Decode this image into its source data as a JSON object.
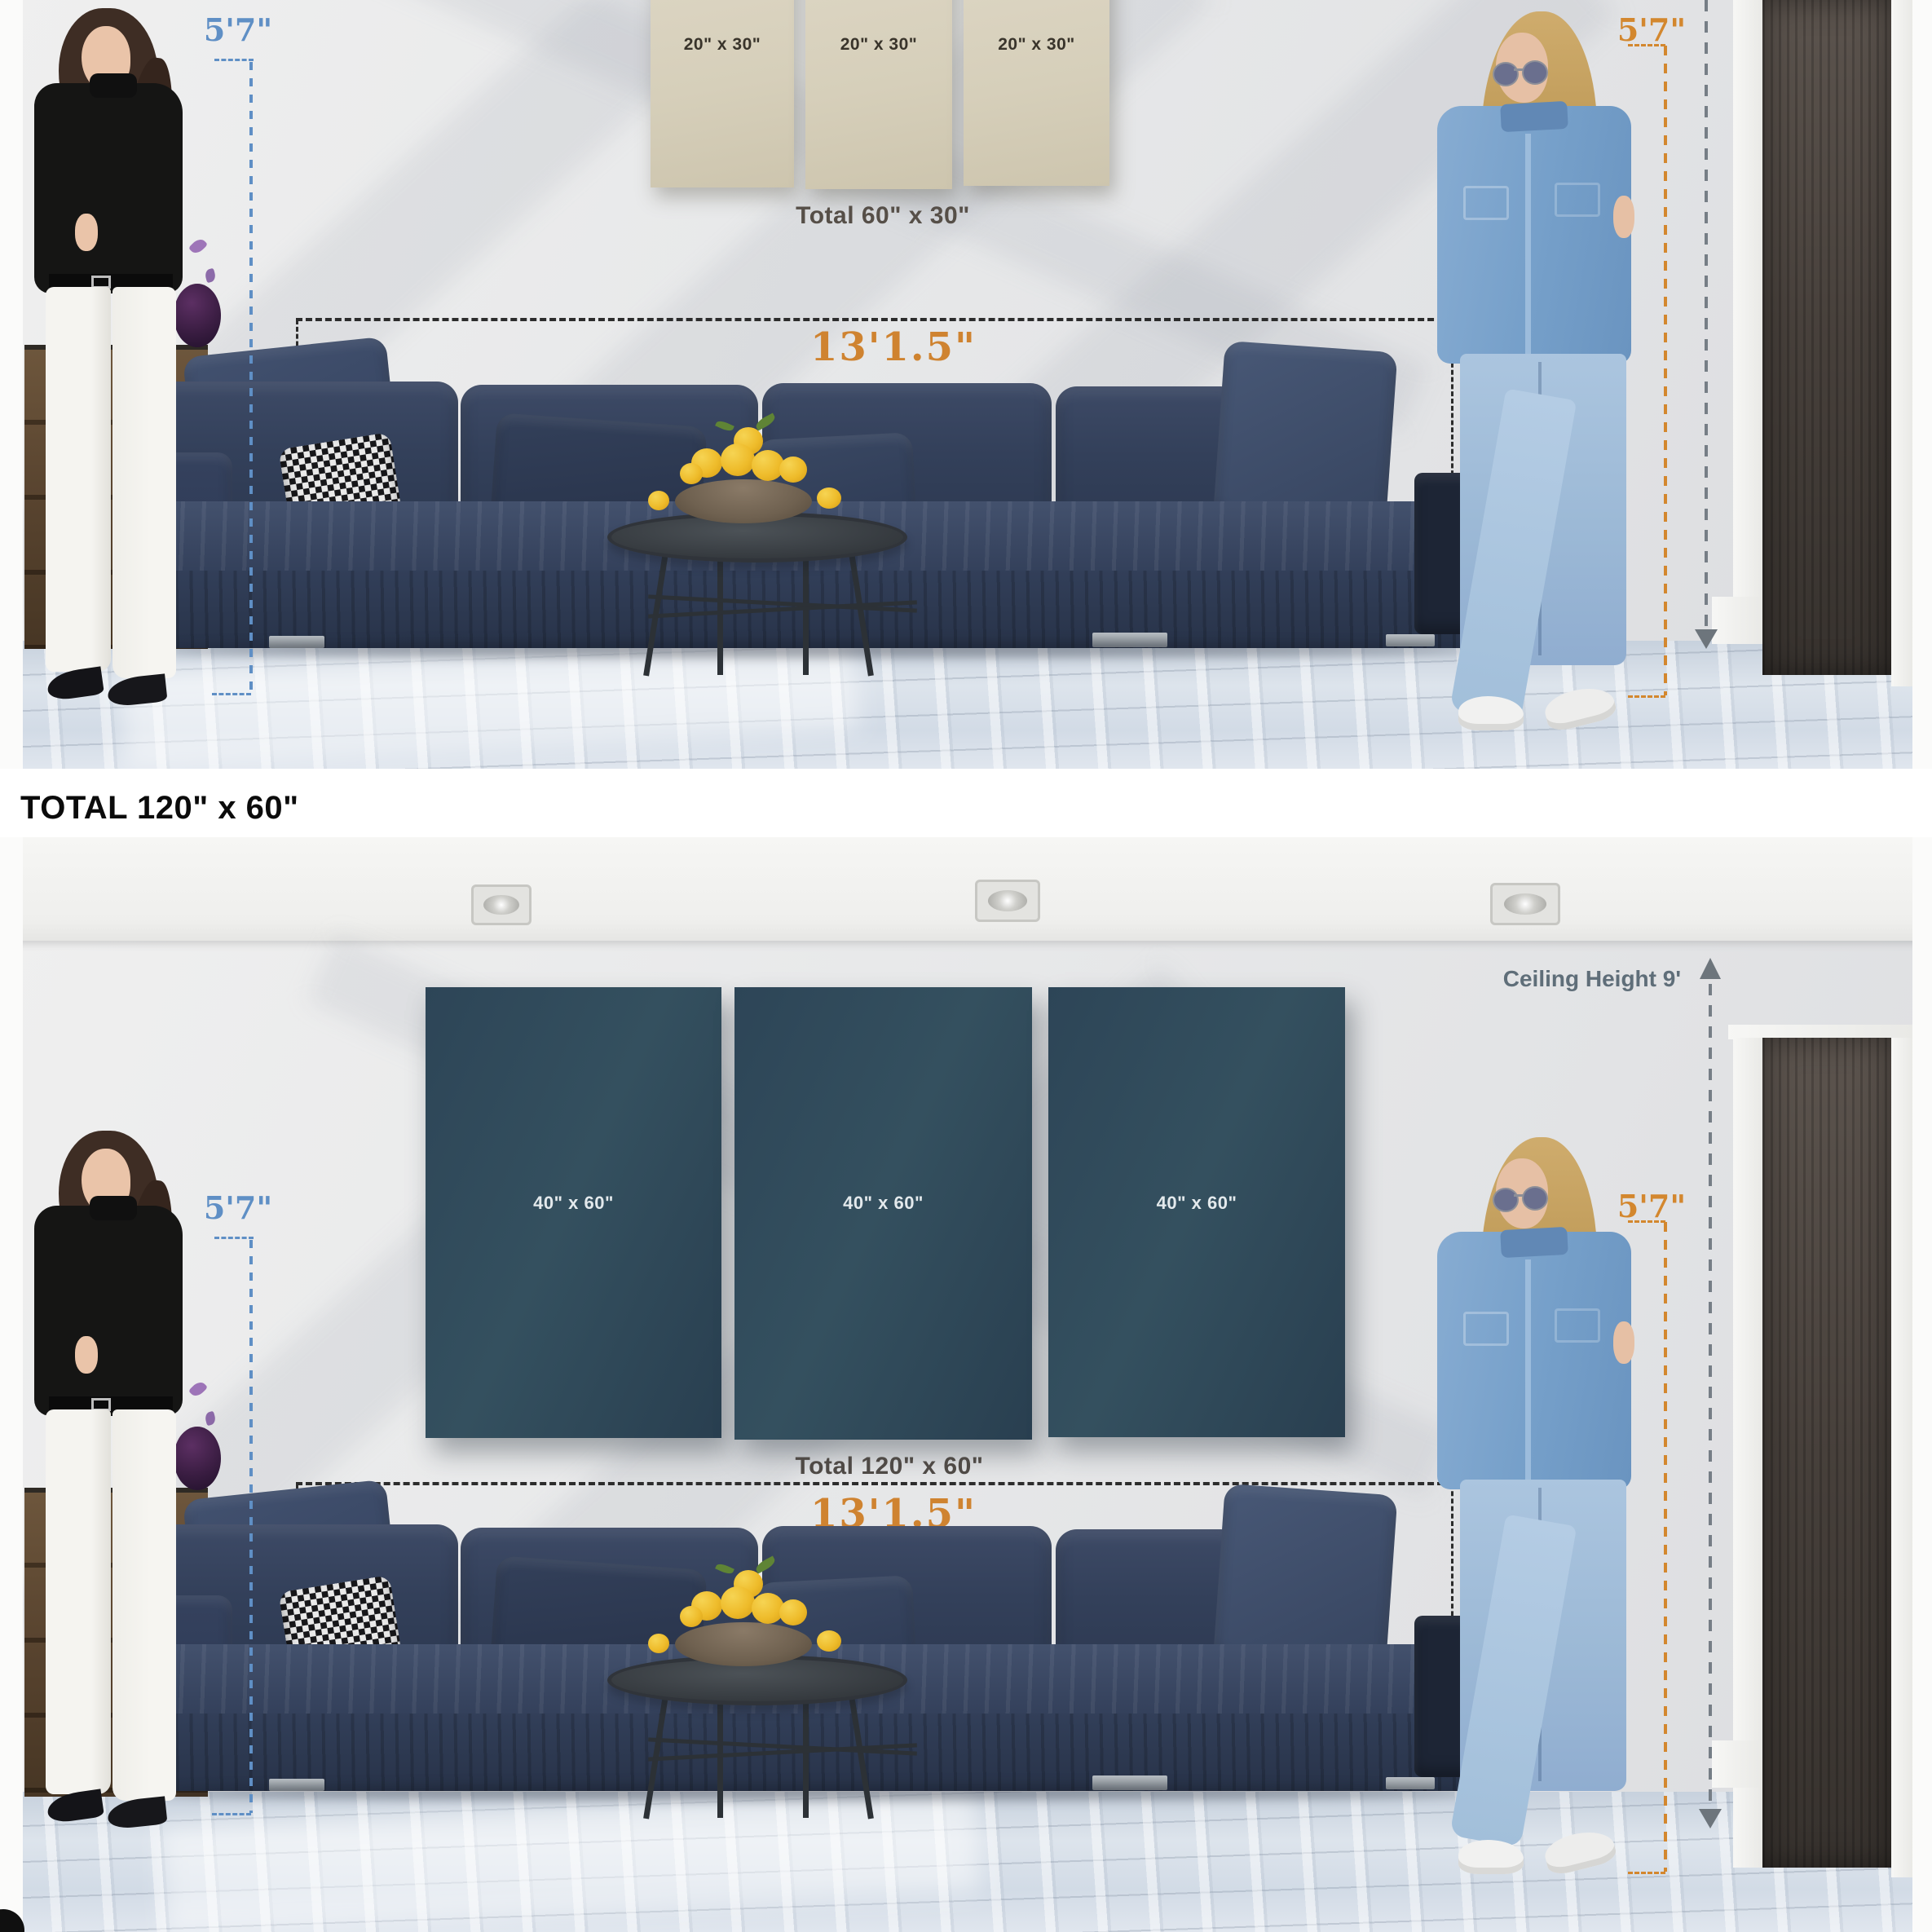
{
  "divider": {
    "title": "TOTAL 120\" x 60\""
  },
  "top_scene": {
    "panels": [
      {
        "label": "20\" x 30\""
      },
      {
        "label": "20\" x 30\""
      },
      {
        "label": "20\" x 30\""
      }
    ],
    "total_label": "Total 60\" x 30\"",
    "width_label": "13'1.5\"",
    "left_height_label": "5'7\"",
    "right_height_label": "5'7\""
  },
  "bottom_scene": {
    "ceiling_label": "Ceiling Height 9'",
    "panels": [
      {
        "label": "40\" x 60\""
      },
      {
        "label": "40\" x 60\""
      },
      {
        "label": "40\" x 60\""
      }
    ],
    "total_label": "Total 120\" x 60\"",
    "width_label": "13'1.5\"",
    "left_height_label": "5'7\"",
    "right_height_label": "5'7\""
  },
  "colors": {
    "accent_orange": "#d3872e",
    "accent_blue": "#5f8fc5",
    "annotation_gray": "#6d757c",
    "panel_beige": "#d6cfba",
    "panel_navy": "#2f4a5d",
    "sofa_navy": "#33405a",
    "floor_gray_blue": "#d5dde7"
  }
}
